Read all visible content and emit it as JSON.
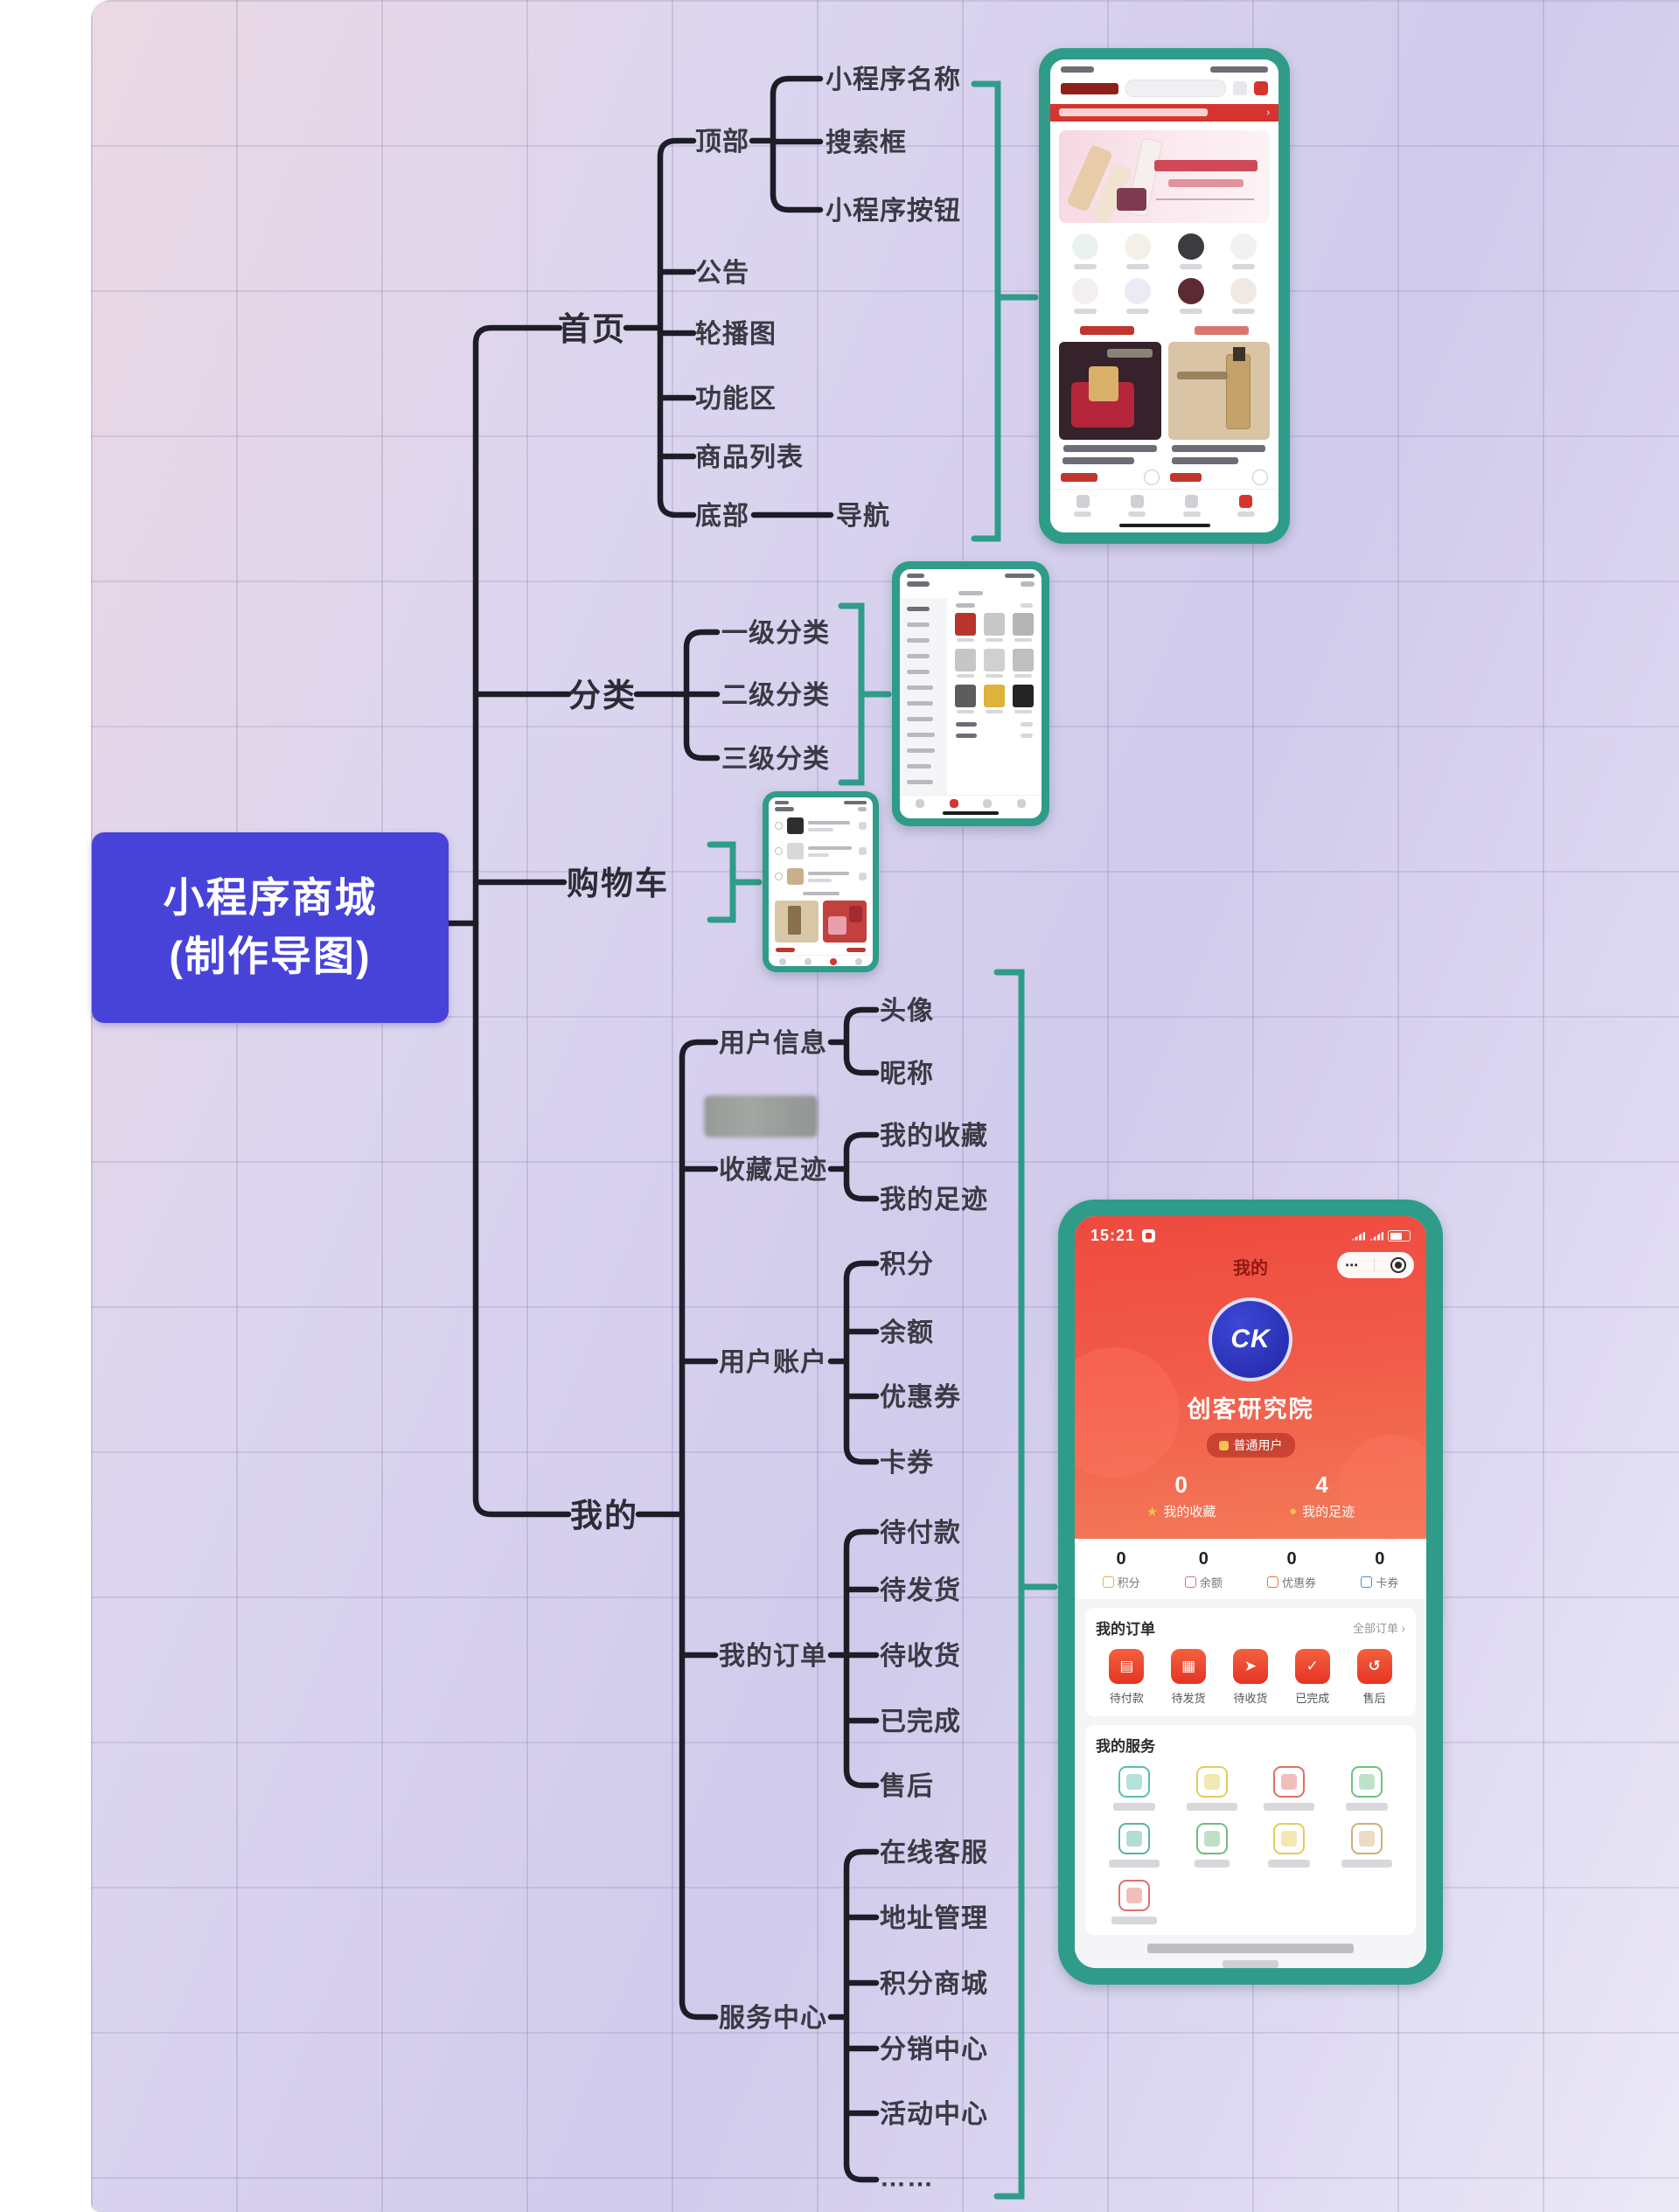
{
  "root": {
    "line1": "小程序商城",
    "line2": "(制作导图)"
  },
  "home": {
    "label": "首页",
    "top": "顶部",
    "top_items": [
      "小程序名称",
      "搜索框",
      "小程序按钮"
    ],
    "notice": "公告",
    "banner": "轮播图",
    "features": "功能区",
    "products": "商品列表",
    "bottom": "底部",
    "nav": "导航"
  },
  "category": {
    "label": "分类",
    "items": [
      "一级分类",
      "二级分类",
      "三级分类"
    ]
  },
  "cart": {
    "label": "购物车"
  },
  "mine": {
    "label": "我的",
    "user_info": {
      "label": "用户信息",
      "items": [
        "头像",
        "昵称"
      ]
    },
    "fav_history": {
      "label": "收藏足迹",
      "items": [
        "我的收藏",
        "我的足迹"
      ]
    },
    "account": {
      "label": "用户账户",
      "items": [
        "积分",
        "余额",
        "优惠券",
        "卡券"
      ]
    },
    "orders": {
      "label": "我的订单",
      "items": [
        "待付款",
        "待发货",
        "待收货",
        "已完成",
        "售后"
      ]
    },
    "services": {
      "label": "服务中心",
      "items": [
        "在线客服",
        "地址管理",
        "积分商城",
        "分销中心",
        "活动中心",
        "……"
      ]
    }
  },
  "profile_phone": {
    "status_time": "15:21",
    "page_title": "我的",
    "menu_dots": "⋯",
    "avatar_logo": "CK",
    "username": "创客研究院",
    "user_badge": "普通用户",
    "fav_count": "0",
    "fav_label": "我的收藏",
    "foot_count": "4",
    "foot_label": "我的足迹",
    "account_stats": [
      {
        "value": "0",
        "label": "积分"
      },
      {
        "value": "0",
        "label": "余额"
      },
      {
        "value": "0",
        "label": "优惠券"
      },
      {
        "value": "0",
        "label": "卡券"
      }
    ],
    "orders_title": "我的订单",
    "orders_all": "全部订单 ›",
    "order_items": [
      "待付款",
      "待发货",
      "待收货",
      "已完成",
      "售后"
    ],
    "services_title": "我的服务",
    "tabs": [
      "首页",
      "分类",
      "购物车",
      "我的"
    ]
  },
  "colors": {
    "frame_teal": "#2f9c8a",
    "root_indigo": "#4843d8",
    "line_black": "#1d1d27"
  }
}
